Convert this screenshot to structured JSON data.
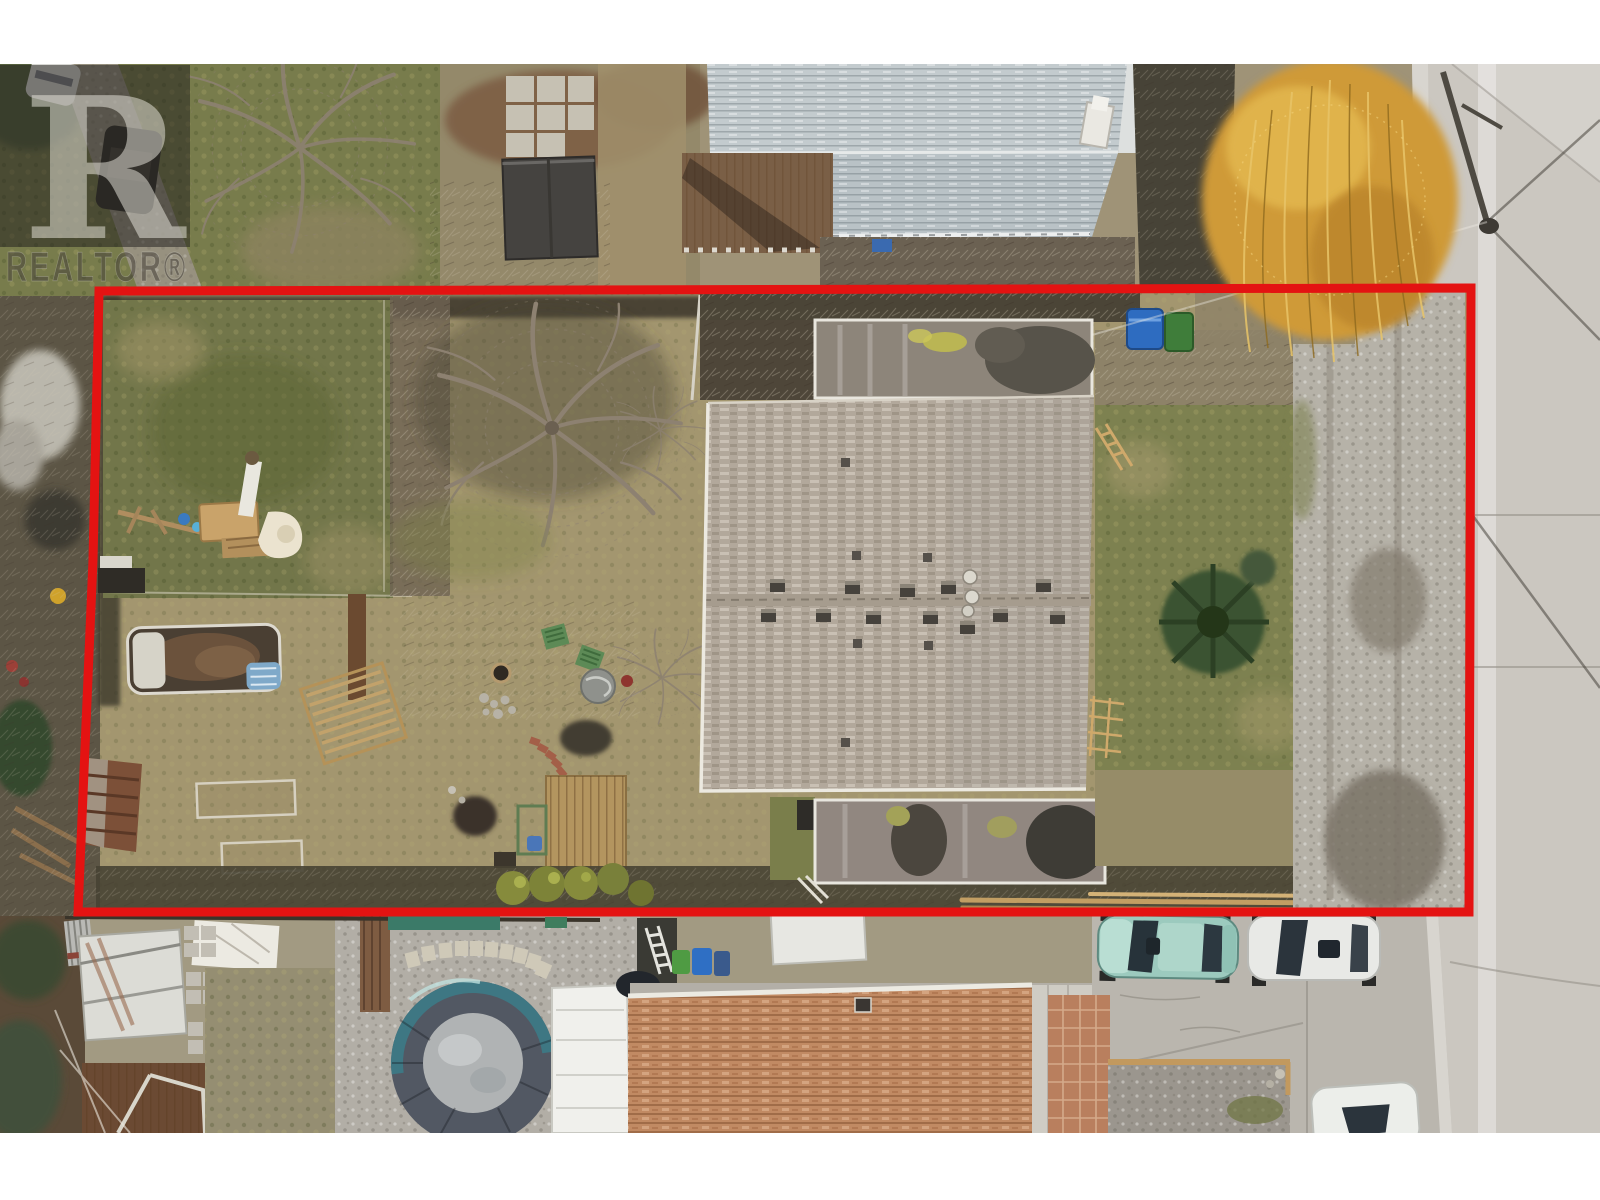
{
  "page": {
    "kind_label": "aerial-real-estate-photo",
    "letterbox_color": "#ffffff"
  },
  "watermark": {
    "logo_letter": "R",
    "brand_text": "REALTOR",
    "registered_mark": "®",
    "brand_display": "REALTOR®",
    "box_color": "rgba(33,31,28,0.52)",
    "logo_letter_color": "rgba(238,235,226,0.5)",
    "brand_text_color": "rgba(72,68,60,0.55)"
  },
  "property_outline": {
    "color": "#e41312",
    "stroke_width": 9
  },
  "palette": {
    "street": "#cbc7c0",
    "main_roof_shingles": "#b2a89b",
    "flat_roof": "#8d857a",
    "neighbor_roof_top": "#c3cbce",
    "neighbor_roof_bottom": "#c18a63",
    "lawn_green": "#757a48",
    "dry_ground": "#9f9377",
    "gravel_driveway": "#b6b2a8",
    "willow_foliage": "#d29f3b",
    "pool_cover": "#525863",
    "pool_ice": "#b0b3b4",
    "teal_car": "#9ccabe",
    "white_car": "#e8e9e6",
    "brick_patio": "#b97f5e"
  },
  "scene": {
    "objects": [
      "neighbor-house-roof-top",
      "deck-neighbor-top",
      "dark-shed-roof",
      "paver-grid",
      "willow-tree",
      "street",
      "utility-pole",
      "power-lines",
      "backyard-lawn",
      "play-structure",
      "garden-trampoline",
      "pergola",
      "garden-shed-brown",
      "raised-garden-beds",
      "bare-tree",
      "garden-deck",
      "patio-chairs",
      "hot-tub-cover",
      "shrub-row",
      "main-house-flat-roof-upper",
      "main-house-shingle-roof",
      "roof-vents",
      "main-house-flat-roof-lower",
      "right-side-lawn",
      "conifer-tree",
      "gravel-driveway",
      "recycling-bins",
      "lumber-pile",
      "covered-pool",
      "stepping-stones",
      "white-shed",
      "patio-canopy",
      "wood-deck",
      "aluminum-ladder",
      "garbage-bins",
      "neighbor-house-roof-bottom",
      "brick-patio",
      "gravel-bed",
      "car-teal",
      "car-white-1",
      "car-white-2",
      "parking-pad"
    ]
  }
}
